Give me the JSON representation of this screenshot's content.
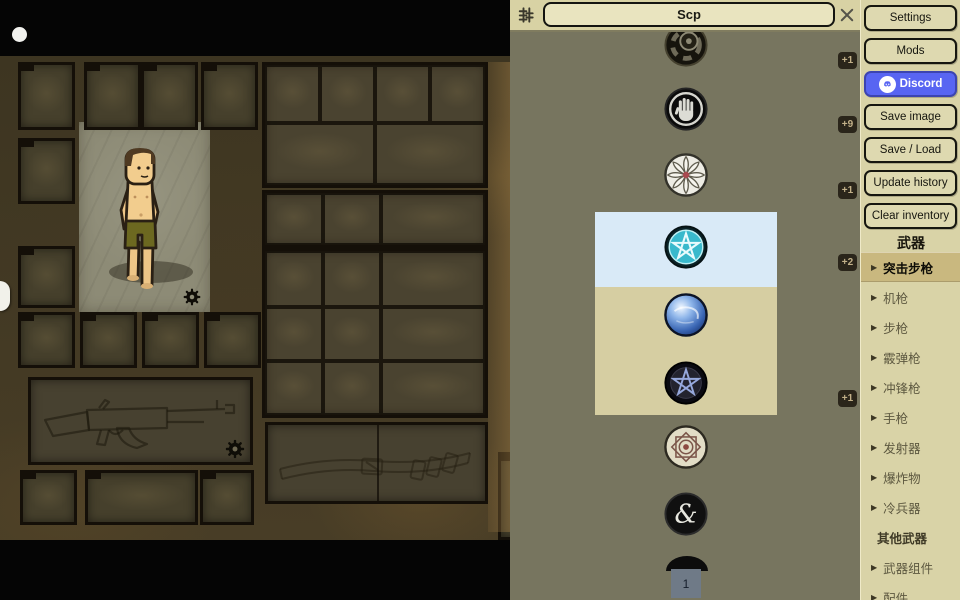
{
  "search": {
    "value": "Scp"
  },
  "item_list": {
    "page": "1",
    "items": [
      {
        "icon": "scp-foundation-badge-icon",
        "badge": "+1"
      },
      {
        "icon": "stop-hand-emblem-icon",
        "badge": "+9"
      },
      {
        "icon": "pinwheel-rose-emblem-icon",
        "badge": "+1"
      },
      {
        "icon": "cyan-pentagram-emblem-icon",
        "badge": "+2",
        "highlight": "blue"
      },
      {
        "icon": "blue-orb-emblem-icon",
        "badge": null,
        "highlight": "tan"
      },
      {
        "icon": "dark-pentagram-emblem-icon",
        "badge": "+1",
        "highlight": "tan"
      },
      {
        "icon": "gear-rose-emblem-icon",
        "badge": null
      },
      {
        "icon": "ampersand-emblem-icon",
        "badge": null
      },
      {
        "icon": "partial-next-emblem-icon",
        "badge": null
      }
    ]
  },
  "sidebar": {
    "buttons": [
      {
        "label": "Settings"
      },
      {
        "label": "Mods"
      },
      {
        "label": "Discord",
        "style": "discord"
      },
      {
        "label": "Save image"
      },
      {
        "label": "Save / Load"
      },
      {
        "label": "Update history"
      },
      {
        "label": "Clear inventory"
      }
    ],
    "section_header": "武器",
    "categories": [
      {
        "label": "突击步枪",
        "arrow": true,
        "selected": true
      },
      {
        "label": "机枪",
        "arrow": true
      },
      {
        "label": "步枪",
        "arrow": true
      },
      {
        "label": "霰弹枪",
        "arrow": true
      },
      {
        "label": "冲锋枪",
        "arrow": true
      },
      {
        "label": "手枪",
        "arrow": true
      },
      {
        "label": "发射器",
        "arrow": true
      },
      {
        "label": "爆炸物",
        "arrow": true
      },
      {
        "label": "冷兵器",
        "arrow": true
      },
      {
        "label": "其他武器",
        "arrow": false,
        "subheader": true
      },
      {
        "label": "武器组件",
        "arrow": true
      },
      {
        "label": "配件",
        "arrow": true
      }
    ]
  },
  "colors": {
    "panel_bg": "#77755f",
    "strip_bg": "#d8d2a4",
    "search_bg": "#e9e4bf",
    "sidebar_bg": "#d9d3a7",
    "button_bg": "#ded9b0",
    "discord_blue": "#5865f2",
    "highlight_blue": "#d9eaf7",
    "highlight_tan": "#d6cea2",
    "selected_category_bg": "#c9b87f",
    "badge_bg": "#2a251a",
    "badge_text": "#c3b189",
    "page_box_bg": "#6f7a87"
  }
}
